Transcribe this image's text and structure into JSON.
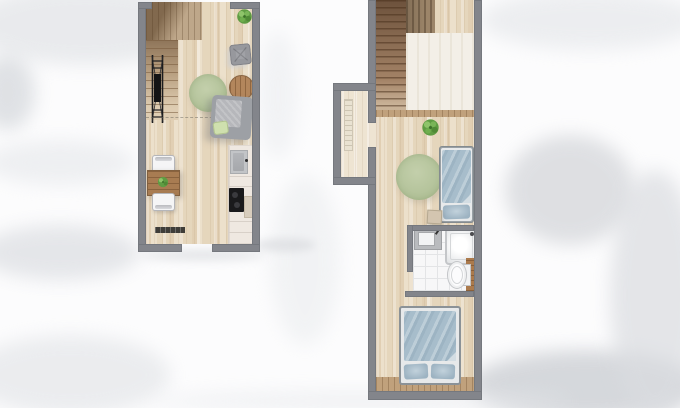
{
  "scene": {
    "type": "floor-plan",
    "description": "Top-down watercolor rendering of a two-level small apartment floor plan",
    "background": "white paper with soft gray watercolor washes",
    "text_content": "none"
  },
  "palette": {
    "wall_gray": "#83858b",
    "floor_wood_light": "#e8dbc4",
    "floor_wood_dark": "#ac9170",
    "stair_wood": "#a8876a",
    "rug_green": "#b5c49c",
    "plant_green": "#5f9c43",
    "bedding_blue": "#a7bdcb",
    "counter_white": "#efe8e1",
    "cooktop_black": "#1a1a1c",
    "tile_white": "#f7f7f8",
    "cabinet_wood": "#ab7a4c",
    "ladder_black": "#1c1c1e"
  },
  "units": [
    {
      "id": "lower-level",
      "rooms": [
        "living-area",
        "dining-area",
        "kitchen",
        "stairwell"
      ],
      "furniture": [
        "staircase",
        "loft-ladder",
        "area-rug",
        "pouf",
        "coffee-table",
        "armchair",
        "potted-plant",
        "dining-table",
        "table-plant",
        "dining-chair-top",
        "dining-chair-bottom",
        "wall-bench",
        "kitchen-counter",
        "kitchen-sink",
        "cooktop",
        "cutting-board"
      ],
      "openings": [
        "stair-opening-top",
        "entry-door-bottom"
      ]
    },
    {
      "id": "upper-level",
      "rooms": [
        "stair-landing",
        "entry-nook",
        "sleeping-area",
        "bathroom",
        "bedroom"
      ],
      "furniture": [
        "staircase",
        "radiator",
        "potted-plant",
        "area-rug",
        "single-bed",
        "bedside-stool",
        "washbasin",
        "shower",
        "toilet",
        "bathroom-cabinet",
        "double-bed"
      ],
      "openings": [
        "nook-doorway",
        "bathroom-doorway"
      ]
    }
  ]
}
